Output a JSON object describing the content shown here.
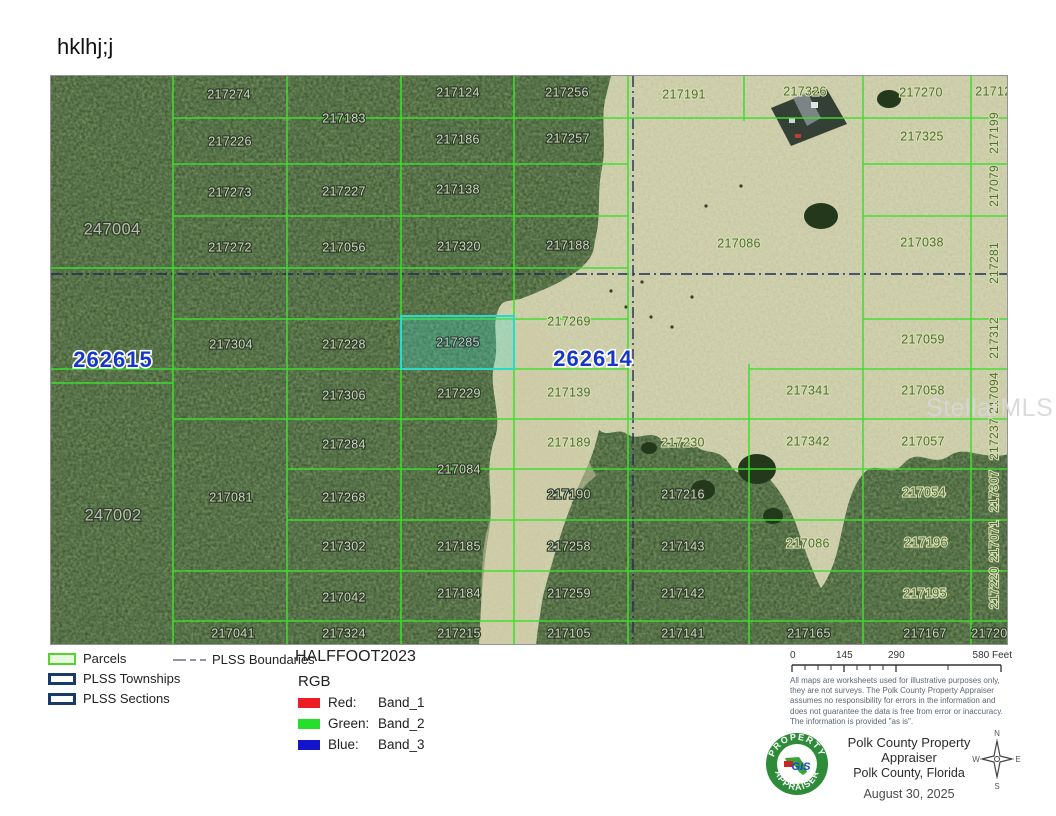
{
  "page": {
    "title": "hklhj;j"
  },
  "watermark": "StellarMLS",
  "map": {
    "parcel_line_color": "#3ede2c",
    "plss_line_color": "#1d2e52",
    "highlight_color": "#2bd9c7",
    "section_label_color": "#1536c8",
    "labels": [
      {
        "t": "217274",
        "x": 178,
        "y": 19,
        "s": "f"
      },
      {
        "t": "217124",
        "x": 407,
        "y": 17,
        "s": "f"
      },
      {
        "t": "217256",
        "x": 516,
        "y": 17,
        "s": "f"
      },
      {
        "t": "217183",
        "x": 293,
        "y": 43,
        "s": "f"
      },
      {
        "t": "217226",
        "x": 179,
        "y": 66,
        "s": "f"
      },
      {
        "t": "217186",
        "x": 407,
        "y": 64,
        "s": "f"
      },
      {
        "t": "217257",
        "x": 517,
        "y": 63,
        "s": "f"
      },
      {
        "t": "217273",
        "x": 179,
        "y": 117,
        "s": "f"
      },
      {
        "t": "217227",
        "x": 293,
        "y": 116,
        "s": "f"
      },
      {
        "t": "217138",
        "x": 407,
        "y": 114,
        "s": "f"
      },
      {
        "t": "217272",
        "x": 179,
        "y": 172,
        "s": "f"
      },
      {
        "t": "217056",
        "x": 293,
        "y": 172,
        "s": "f"
      },
      {
        "t": "217320",
        "x": 408,
        "y": 171,
        "s": "f"
      },
      {
        "t": "217188",
        "x": 517,
        "y": 170,
        "s": "f"
      },
      {
        "t": "217304",
        "x": 180,
        "y": 269,
        "s": "f"
      },
      {
        "t": "217228",
        "x": 293,
        "y": 269,
        "s": "f"
      },
      {
        "t": "217229",
        "x": 408,
        "y": 318,
        "s": "f"
      },
      {
        "t": "217306",
        "x": 293,
        "y": 320,
        "s": "f"
      },
      {
        "t": "217284",
        "x": 293,
        "y": 369,
        "s": "f"
      },
      {
        "t": "217084",
        "x": 408,
        "y": 394,
        "s": "f"
      },
      {
        "t": "217081",
        "x": 180,
        "y": 422,
        "s": "f"
      },
      {
        "t": "217268",
        "x": 293,
        "y": 422,
        "s": "f"
      },
      {
        "t": "217302",
        "x": 293,
        "y": 471,
        "s": "f"
      },
      {
        "t": "217185",
        "x": 408,
        "y": 471,
        "s": "f"
      },
      {
        "t": "217042",
        "x": 293,
        "y": 522,
        "s": "f"
      },
      {
        "t": "217184",
        "x": 408,
        "y": 518,
        "s": "f"
      },
      {
        "t": "217041",
        "x": 182,
        "y": 558,
        "s": "f"
      },
      {
        "t": "217324",
        "x": 293,
        "y": 558,
        "s": "f"
      },
      {
        "t": "217215",
        "x": 408,
        "y": 558,
        "s": "f"
      },
      {
        "t": "217190",
        "x": 518,
        "y": 419,
        "s": "f"
      },
      {
        "t": "217258",
        "x": 518,
        "y": 471,
        "s": "f"
      },
      {
        "t": "217259",
        "x": 518,
        "y": 518,
        "s": "f"
      },
      {
        "t": "217105",
        "x": 518,
        "y": 558,
        "s": "f"
      },
      {
        "t": "217216",
        "x": 632,
        "y": 419,
        "s": "f"
      },
      {
        "t": "217143",
        "x": 632,
        "y": 471,
        "s": "f"
      },
      {
        "t": "217142",
        "x": 632,
        "y": 518,
        "s": "f"
      },
      {
        "t": "217141",
        "x": 632,
        "y": 558,
        "s": "f"
      },
      {
        "t": "217165",
        "x": 758,
        "y": 558,
        "s": "f"
      },
      {
        "t": "217167",
        "x": 874,
        "y": 558,
        "s": "f"
      },
      {
        "t": "217200",
        "x": 942,
        "y": 558,
        "s": "f"
      },
      {
        "t": "217191",
        "x": 633,
        "y": 19,
        "s": "p"
      },
      {
        "t": "217326",
        "x": 754,
        "y": 16,
        "s": "p"
      },
      {
        "t": "217270",
        "x": 870,
        "y": 17,
        "s": "p"
      },
      {
        "t": "217127",
        "x": 946,
        "y": 16,
        "s": "p"
      },
      {
        "t": "217325",
        "x": 871,
        "y": 61,
        "s": "p"
      },
      {
        "t": "217086",
        "x": 688,
        "y": 168,
        "s": "p"
      },
      {
        "t": "217038",
        "x": 871,
        "y": 167,
        "s": "p"
      },
      {
        "t": "217269",
        "x": 518,
        "y": 246,
        "s": "p"
      },
      {
        "t": "217139",
        "x": 518,
        "y": 317,
        "s": "p"
      },
      {
        "t": "217189",
        "x": 518,
        "y": 367,
        "s": "p"
      },
      {
        "t": "217230",
        "x": 632,
        "y": 367,
        "s": "p"
      },
      {
        "t": "217059",
        "x": 872,
        "y": 264,
        "s": "p"
      },
      {
        "t": "217341",
        "x": 757,
        "y": 315,
        "s": "p"
      },
      {
        "t": "217058",
        "x": 872,
        "y": 315,
        "s": "p"
      },
      {
        "t": "217342",
        "x": 757,
        "y": 366,
        "s": "p"
      },
      {
        "t": "217057",
        "x": 872,
        "y": 366,
        "s": "p"
      },
      {
        "t": "217054",
        "x": 873,
        "y": 417,
        "s": "p"
      },
      {
        "t": "217196",
        "x": 875,
        "y": 467,
        "s": "p"
      },
      {
        "t": "217195",
        "x": 874,
        "y": 518,
        "s": "p"
      },
      {
        "t": "217086",
        "x": 757,
        "y": 468,
        "s": "p"
      },
      {
        "t": "217199",
        "x": 944,
        "y": 57,
        "s": "pv"
      },
      {
        "t": "217079",
        "x": 944,
        "y": 110,
        "s": "pv"
      },
      {
        "t": "217281",
        "x": 944,
        "y": 187,
        "s": "pv"
      },
      {
        "t": "217312",
        "x": 944,
        "y": 262,
        "s": "pv"
      },
      {
        "t": "217094",
        "x": 944,
        "y": 317,
        "s": "pv"
      },
      {
        "t": "217237",
        "x": 944,
        "y": 363,
        "s": "pv"
      },
      {
        "t": "217307",
        "x": 944,
        "y": 415,
        "s": "pv"
      },
      {
        "t": "217071",
        "x": 944,
        "y": 465,
        "s": "pv"
      },
      {
        "t": "217220",
        "x": 944,
        "y": 512,
        "s": "pv"
      },
      {
        "t": "247004",
        "x": 61,
        "y": 154,
        "s": "t"
      },
      {
        "t": "247002",
        "x": 62,
        "y": 440,
        "s": "t"
      },
      {
        "t": "262615",
        "x": 62,
        "y": 285,
        "s": "sec"
      },
      {
        "t": "262614",
        "x": 542,
        "y": 284,
        "s": "sec"
      },
      {
        "t": "217285",
        "x": 407,
        "y": 267,
        "s": "h"
      }
    ]
  },
  "legend": {
    "parcels": "Parcels",
    "townships": "PLSS Townships",
    "sections": "PLSS Sections",
    "boundaries": "PLSS Boundaries"
  },
  "raster": {
    "title": "HALFFOOT2023",
    "subtitle": "RGB",
    "bands": [
      {
        "color": "#ee1c25",
        "label": "Red:",
        "value": "Band_1"
      },
      {
        "color": "#26df2b",
        "label": "Green:",
        "value": "Band_2"
      },
      {
        "color": "#1414cc",
        "label": "Blue:",
        "value": "Band_3"
      }
    ]
  },
  "scalebar": {
    "ticks": [
      "0",
      "145",
      "290",
      "580 Feet"
    ]
  },
  "disclaimer": "All maps are worksheets used for illustrative purposes only, they are not surveys. The Polk County Property Appraiser assumes no responsibility for errors in the information and does not guarantee the data is free from error or inaccuracy. The information is provided \"as is\".",
  "credits": {
    "line1": "Polk County Property Appraiser",
    "line2": "Polk County, Florida",
    "date": "August 30, 2025"
  },
  "logo": {
    "top": "PROPERTY",
    "bottom": "APPRAISER",
    "center": "GIS"
  },
  "compass": {
    "n": "N",
    "s": "S",
    "e": "E",
    "w": "W"
  }
}
